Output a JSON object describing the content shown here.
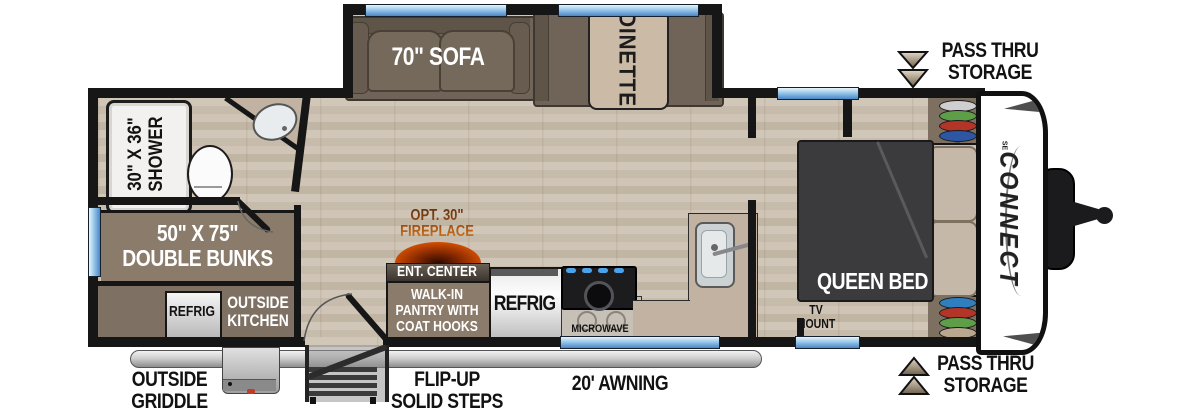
{
  "labels": {
    "sofa": "70\" SOFA",
    "dinette": "DINETTE",
    "shower_l1": "30\" X 36\"",
    "shower_l2": "SHOWER",
    "bunks_l1": "50\" X 75\"",
    "bunks_l2": "DOUBLE BUNKS",
    "outside_refrig": "REFRIG",
    "outside_kitchen_l1": "OUTSIDE",
    "outside_kitchen_l2": "KITCHEN",
    "fireplace_l1": "OPT. 30\"",
    "fireplace_l2": "FIREPLACE",
    "ent_center": "ENT. CENTER",
    "pantry_l1": "WALK-IN",
    "pantry_l2": "PANTRY WITH",
    "pantry_l3": "COAT HOOKS",
    "refrig": "REFRIG",
    "microwave": "MICROWAVE",
    "queen_bed": "QUEEN BED",
    "tv_mount_l1": "TV",
    "tv_mount_l2": "MOUNT",
    "brand": "CONNECT",
    "brand_sub": "SE",
    "pass_thru_top_l1": "PASS THRU",
    "pass_thru_top_l2": "STORAGE",
    "pass_thru_bottom_l1": "PASS THRU",
    "pass_thru_bottom_l2": "STORAGE",
    "griddle_l1": "OUTSIDE",
    "griddle_l2": "GRIDDLE",
    "steps_l1": "FLIP-UP",
    "steps_l2": "SOLID STEPS",
    "awning": "20' AWNING"
  },
  "discs": {
    "top": [
      "#cfcfcf",
      "#5f9e49",
      "#b23527",
      "#2d56a5"
    ],
    "bottom": [
      "#2f7fc0",
      "#b23527",
      "#5f9e49",
      "#b9a88e"
    ]
  },
  "colors": {
    "wall": "#161616",
    "floor_base": "#cbc0b0",
    "sofa_brown": "#6f6457",
    "sofa_dark": "#3f3830",
    "table_tan": "#cbbaa5",
    "box_brown": "#8a7b6b",
    "area_brown": "#7e7163",
    "bed_dark": "#3b3b3e",
    "pillow_tan": "#c6b8a8",
    "counter_beige": "#c2b2a1",
    "window_blue": "#4a86c8",
    "fire_orange": "#e06010",
    "fire_yellow": "#f6a41f",
    "arrow_tan": "#b7a78e",
    "awning_gray": "#cfcfcf"
  }
}
